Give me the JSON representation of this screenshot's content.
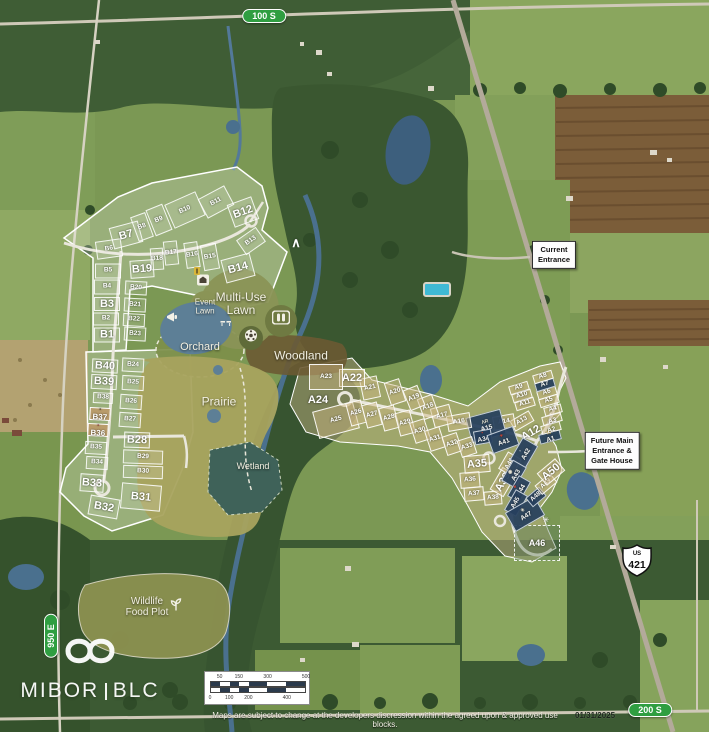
{
  "meta": {
    "width": 709,
    "height": 732
  },
  "road_labels": [
    {
      "id": "100-s",
      "text": "100 S"
    },
    {
      "id": "950-e",
      "text": "950 E"
    },
    {
      "id": "200-s",
      "text": "200 S"
    }
  ],
  "highway_shield": {
    "us": "US",
    "number": "421"
  },
  "callouts": [
    {
      "id": "current-entrance",
      "lines": [
        "Current",
        "Entrance"
      ]
    },
    {
      "id": "future-entrance",
      "lines": [
        "Future Main",
        "Entrance &",
        "Gate House"
      ]
    }
  ],
  "amenity_labels": [
    {
      "id": "event-lawn",
      "lines": [
        "Event",
        "Lawn"
      ],
      "x": 205,
      "y": 307,
      "fs": 8
    },
    {
      "id": "multi-use-lawn",
      "lines": [
        "Multi-Use",
        "Lawn"
      ],
      "x": 241,
      "y": 304,
      "fs": 12
    },
    {
      "id": "orchard",
      "lines": [
        "Orchard"
      ],
      "x": 200,
      "y": 348,
      "fs": 11
    },
    {
      "id": "woodland",
      "lines": [
        "Woodland"
      ],
      "x": 301,
      "y": 356,
      "fs": 12
    },
    {
      "id": "prairie",
      "lines": [
        "Prairie"
      ],
      "x": 219,
      "y": 402,
      "fs": 12
    },
    {
      "id": "wetland",
      "lines": [
        "Wetland"
      ],
      "x": 253,
      "y": 467,
      "fs": 9
    },
    {
      "id": "wildlife-food-plot",
      "lines": [
        "Wildlife",
        "Food Plot"
      ],
      "x": 147,
      "y": 608,
      "fs": 10
    }
  ],
  "icons": [
    {
      "name": "barn-icon"
    },
    {
      "name": "h-marker-icon"
    },
    {
      "name": "megaphone-icon"
    },
    {
      "name": "picnic-icon"
    },
    {
      "name": "soccer-ball-icon"
    },
    {
      "name": "pickleball-court-icon"
    },
    {
      "name": "mountain-icon",
      "glyph": "∧"
    },
    {
      "name": "sprout-icon"
    },
    {
      "name": "compass-icon",
      "glyph": "✳"
    }
  ],
  "mountain_glyph": "∧",
  "lots": {
    "b": [
      {
        "id": "B1",
        "x": 107,
        "y": 335,
        "w": 26,
        "h": 15,
        "r": 0,
        "t": "g",
        "e": true
      },
      {
        "id": "B2",
        "x": 106,
        "y": 319,
        "w": 26,
        "h": 13,
        "r": 0,
        "t": "g"
      },
      {
        "id": "B3",
        "x": 107,
        "y": 304,
        "w": 26,
        "h": 14,
        "r": 0,
        "t": "g",
        "e": true
      },
      {
        "id": "B4",
        "x": 107,
        "y": 287,
        "w": 26,
        "h": 15,
        "r": 0,
        "t": "g"
      },
      {
        "id": "B5",
        "x": 108,
        "y": 271,
        "w": 26,
        "h": 15,
        "r": 0,
        "t": "g"
      },
      {
        "id": "B6",
        "x": 109,
        "y": 249,
        "w": 26,
        "h": 18,
        "r": -8,
        "t": "g"
      },
      {
        "id": "B7",
        "x": 126,
        "y": 235,
        "w": 30,
        "h": 22,
        "r": -15,
        "t": "g",
        "e": true
      },
      {
        "id": "B8",
        "x": 142,
        "y": 227,
        "w": 16,
        "h": 26,
        "r": -20,
        "t": "g"
      },
      {
        "id": "B9",
        "x": 159,
        "y": 220,
        "w": 18,
        "h": 28,
        "r": -22,
        "t": "g"
      },
      {
        "id": "B10",
        "x": 185,
        "y": 210,
        "w": 34,
        "h": 26,
        "r": -24,
        "t": "g"
      },
      {
        "id": "B11",
        "x": 216,
        "y": 202,
        "w": 30,
        "h": 22,
        "r": -28,
        "t": "g"
      },
      {
        "id": "B12",
        "x": 243,
        "y": 212,
        "w": 26,
        "h": 24,
        "r": -20,
        "t": "g",
        "e": true
      },
      {
        "id": "B13",
        "x": 251,
        "y": 241,
        "w": 24,
        "h": 18,
        "r": -35,
        "t": "g"
      },
      {
        "id": "B14",
        "x": 238,
        "y": 268,
        "w": 30,
        "h": 24,
        "r": -15,
        "t": "g",
        "e": true
      },
      {
        "id": "B15",
        "x": 210,
        "y": 257,
        "w": 16,
        "h": 26,
        "r": -10,
        "t": "g"
      },
      {
        "id": "B16",
        "x": 192,
        "y": 255,
        "w": 14,
        "h": 26,
        "r": -8,
        "t": "g"
      },
      {
        "id": "B17",
        "x": 171,
        "y": 253,
        "w": 14,
        "h": 24,
        "r": -6,
        "t": "g"
      },
      {
        "id": "B18",
        "x": 157,
        "y": 259,
        "w": 13,
        "h": 22,
        "r": -4,
        "t": "g"
      },
      {
        "id": "B19",
        "x": 142,
        "y": 269,
        "w": 24,
        "h": 18,
        "r": -4,
        "t": "g",
        "e": true
      },
      {
        "id": "B20",
        "x": 136,
        "y": 288,
        "w": 22,
        "h": 14,
        "r": 3,
        "t": "g"
      },
      {
        "id": "B21",
        "x": 135,
        "y": 305,
        "w": 22,
        "h": 14,
        "r": 3,
        "t": "g"
      },
      {
        "id": "B22",
        "x": 134,
        "y": 320,
        "w": 22,
        "h": 13,
        "r": 3,
        "t": "g"
      },
      {
        "id": "B23",
        "x": 135,
        "y": 334,
        "w": 22,
        "h": 14,
        "r": 3,
        "t": "g"
      },
      {
        "id": "B24",
        "x": 133,
        "y": 365,
        "w": 22,
        "h": 14,
        "r": 3,
        "t": "g"
      },
      {
        "id": "B25",
        "x": 133,
        "y": 383,
        "w": 22,
        "h": 15,
        "r": 3,
        "t": "g"
      },
      {
        "id": "B26",
        "x": 131,
        "y": 402,
        "w": 22,
        "h": 15,
        "r": 4,
        "t": "g"
      },
      {
        "id": "B27",
        "x": 130,
        "y": 420,
        "w": 22,
        "h": 15,
        "r": 4,
        "t": "g"
      },
      {
        "id": "B28",
        "x": 137,
        "y": 440,
        "w": 26,
        "h": 16,
        "r": 2,
        "t": "g",
        "e": true
      },
      {
        "id": "B29",
        "x": 143,
        "y": 457,
        "w": 40,
        "h": 14,
        "r": 2,
        "t": "g"
      },
      {
        "id": "B30",
        "x": 143,
        "y": 472,
        "w": 40,
        "h": 13,
        "r": 2,
        "t": "g"
      },
      {
        "id": "B31",
        "x": 141,
        "y": 497,
        "w": 40,
        "h": 26,
        "r": 5,
        "t": "g",
        "e": true
      },
      {
        "id": "B32",
        "x": 104,
        "y": 507,
        "w": 30,
        "h": 20,
        "r": 10,
        "t": "g",
        "e": true
      },
      {
        "id": "B33",
        "x": 92,
        "y": 483,
        "w": 24,
        "h": 18,
        "r": 4,
        "t": "g",
        "e": true
      },
      {
        "id": "B34",
        "x": 97,
        "y": 463,
        "w": 22,
        "h": 13,
        "r": 3,
        "t": "g"
      },
      {
        "id": "B35",
        "x": 96,
        "y": 448,
        "w": 22,
        "h": 13,
        "r": 3,
        "t": "g"
      },
      {
        "id": "B36",
        "x": 98,
        "y": 430,
        "w": 21,
        "h": 13,
        "r": 3,
        "t": "p",
        "e": true,
        "fs": 8,
        "logo": "▪",
        "lc": "#8a3030"
      },
      {
        "id": "B37",
        "x": 100,
        "y": 414,
        "w": 21,
        "h": 13,
        "r": 3,
        "t": "p",
        "e": true,
        "fs": 8,
        "logo": "▪",
        "lc": "#4a3a28"
      },
      {
        "id": "B38",
        "x": 103,
        "y": 398,
        "w": 20,
        "h": 11,
        "r": 3,
        "t": "g"
      },
      {
        "id": "B39",
        "x": 104,
        "y": 382,
        "w": 26,
        "h": 15,
        "r": 3,
        "t": "g",
        "e": true
      },
      {
        "id": "B40",
        "x": 105,
        "y": 366,
        "w": 26,
        "h": 14,
        "r": 3,
        "t": "g",
        "e": true
      }
    ],
    "a": [
      {
        "id": "A1",
        "x": 550,
        "y": 437,
        "w": 22,
        "h": 10,
        "r": -15,
        "t": "n",
        "logo": "M",
        "lc": "#d8b04a"
      },
      {
        "id": "A2",
        "x": 551,
        "y": 428,
        "w": 20,
        "h": 9,
        "r": -15,
        "t": "t",
        "logo": "✳",
        "lc": "#ffffff"
      },
      {
        "id": "A3",
        "x": 552,
        "y": 419,
        "w": 20,
        "h": 9,
        "r": -15,
        "t": "t",
        "logo": "✳",
        "lc": "#ffffff"
      },
      {
        "id": "A4",
        "x": 553,
        "y": 410,
        "w": 18,
        "h": 9,
        "r": -15,
        "t": "t"
      },
      {
        "id": "A5",
        "x": 549,
        "y": 401,
        "w": 20,
        "h": 9,
        "r": -17,
        "t": "t"
      },
      {
        "id": "A6",
        "x": 547,
        "y": 393,
        "w": 20,
        "h": 9,
        "r": -17,
        "t": "t"
      },
      {
        "id": "A7",
        "x": 545,
        "y": 385,
        "w": 20,
        "h": 9,
        "r": -17,
        "t": "n"
      },
      {
        "id": "A8",
        "x": 543,
        "y": 377,
        "w": 20,
        "h": 9,
        "r": -17,
        "t": "t"
      },
      {
        "id": "A9",
        "x": 519,
        "y": 388,
        "w": 20,
        "h": 9,
        "r": -17,
        "t": "t"
      },
      {
        "id": "A10",
        "x": 522,
        "y": 396,
        "w": 20,
        "h": 9,
        "r": -17,
        "t": "t"
      },
      {
        "id": "A11",
        "x": 525,
        "y": 404,
        "w": 20,
        "h": 9,
        "r": -17,
        "t": "t"
      },
      {
        "id": "A12",
        "x": 531,
        "y": 433,
        "w": 30,
        "h": 16,
        "r": -30,
        "t": "x",
        "e": true
      },
      {
        "id": "A13",
        "x": 522,
        "y": 421,
        "w": 22,
        "h": 12,
        "r": -30,
        "t": "t"
      },
      {
        "id": "A14",
        "x": 504,
        "y": 422,
        "w": 22,
        "h": 14,
        "r": -10,
        "t": "t"
      },
      {
        "id": "A15",
        "x": 486,
        "y": 426,
        "w": 36,
        "h": 26,
        "r": -15,
        "t": "n",
        "logo": "ΛR",
        "lc": "#e8e4d8"
      },
      {
        "id": "A16",
        "x": 459,
        "y": 422,
        "w": 24,
        "h": 16,
        "r": -10,
        "t": "t"
      },
      {
        "id": "A17",
        "x": 442,
        "y": 416,
        "w": 20,
        "h": 20,
        "r": -15,
        "t": "t"
      },
      {
        "id": "A18",
        "x": 428,
        "y": 407,
        "w": 16,
        "h": 22,
        "r": -20,
        "t": "t"
      },
      {
        "id": "A19",
        "x": 414,
        "y": 398,
        "w": 16,
        "h": 22,
        "r": -22,
        "t": "t"
      },
      {
        "id": "A20",
        "x": 395,
        "y": 392,
        "w": 16,
        "h": 24,
        "r": -18,
        "t": "t"
      },
      {
        "id": "A21",
        "x": 370,
        "y": 388,
        "w": 18,
        "h": 22,
        "r": -12,
        "t": "t"
      },
      {
        "id": "A22",
        "x": 352,
        "y": 378,
        "w": 26,
        "h": 18,
        "r": 0,
        "t": "t",
        "e": true
      },
      {
        "id": "A23",
        "x": 326,
        "y": 377,
        "w": 34,
        "h": 26,
        "r": 0,
        "t": "t"
      },
      {
        "id": "A24",
        "x": 318,
        "y": 400,
        "w": 30,
        "h": 22,
        "r": 0,
        "t": "x",
        "e": true
      },
      {
        "id": "A25",
        "x": 336,
        "y": 420,
        "w": 42,
        "h": 28,
        "r": -15,
        "t": "t"
      },
      {
        "id": "A26",
        "x": 356,
        "y": 413,
        "w": 16,
        "h": 24,
        "r": -15,
        "t": "t"
      },
      {
        "id": "A27",
        "x": 372,
        "y": 415,
        "w": 16,
        "h": 24,
        "r": -15,
        "t": "t"
      },
      {
        "id": "A28",
        "x": 389,
        "y": 418,
        "w": 16,
        "h": 24,
        "r": -15,
        "t": "t"
      },
      {
        "id": "A29",
        "x": 405,
        "y": 423,
        "w": 16,
        "h": 24,
        "r": -15,
        "t": "t"
      },
      {
        "id": "A30",
        "x": 420,
        "y": 431,
        "w": 16,
        "h": 22,
        "r": -18,
        "t": "t"
      },
      {
        "id": "A31",
        "x": 435,
        "y": 439,
        "w": 16,
        "h": 22,
        "r": -18,
        "t": "t"
      },
      {
        "id": "A32",
        "x": 452,
        "y": 444,
        "w": 16,
        "h": 20,
        "r": -18,
        "t": "t"
      },
      {
        "id": "A33",
        "x": 467,
        "y": 447,
        "w": 16,
        "h": 18,
        "r": -18,
        "t": "t"
      },
      {
        "id": "A34",
        "x": 483,
        "y": 437,
        "w": 18,
        "h": 14,
        "r": -10,
        "t": "n",
        "logo": "▪",
        "lc": "#c43b2e"
      },
      {
        "id": "A35",
        "x": 477,
        "y": 464,
        "w": 26,
        "h": 18,
        "r": -5,
        "t": "t",
        "e": true
      },
      {
        "id": "A36",
        "x": 470,
        "y": 480,
        "w": 20,
        "h": 16,
        "r": -5,
        "t": "t"
      },
      {
        "id": "A37",
        "x": 474,
        "y": 494,
        "w": 20,
        "h": 14,
        "r": -5,
        "t": "t"
      },
      {
        "id": "A38",
        "x": 493,
        "y": 498,
        "w": 18,
        "h": 14,
        "r": -5,
        "t": "t"
      },
      {
        "id": "A39",
        "x": 503,
        "y": 482,
        "w": 26,
        "h": 16,
        "r": -60,
        "t": "t",
        "e": true
      },
      {
        "id": "A40",
        "x": 510,
        "y": 464,
        "w": 20,
        "h": 16,
        "r": -60,
        "t": "t"
      },
      {
        "id": "A41",
        "x": 503,
        "y": 440,
        "w": 28,
        "h": 20,
        "r": -20,
        "t": "n",
        "logo": "✦",
        "lc": "#c43b2e"
      },
      {
        "id": "A42",
        "x": 524,
        "y": 453,
        "w": 26,
        "h": 18,
        "r": -60,
        "t": "n",
        "logo": "▫",
        "lc": "#ffffff"
      },
      {
        "id": "A43",
        "x": 514,
        "y": 474,
        "w": 24,
        "h": 16,
        "r": -60,
        "t": "n",
        "logo": "◉",
        "lc": "#e8e4d8"
      },
      {
        "id": "A44",
        "x": 519,
        "y": 489,
        "w": 24,
        "h": 14,
        "r": -60,
        "t": "n",
        "logo": "✦",
        "lc": "#c43b2e"
      },
      {
        "id": "A45",
        "x": 516,
        "y": 503,
        "w": 24,
        "h": 14,
        "r": -60,
        "t": "n"
      },
      {
        "id": "A46",
        "x": 537,
        "y": 543,
        "w": 46,
        "h": 36,
        "r": 0,
        "t": "d",
        "fs": 9
      },
      {
        "id": "A47",
        "x": 525,
        "y": 514,
        "w": 34,
        "h": 22,
        "r": -30,
        "t": "n",
        "logo": "✳",
        "lc": "#e8e4d8"
      },
      {
        "id": "A48",
        "x": 536,
        "y": 497,
        "w": 18,
        "h": 12,
        "r": -40,
        "t": "n"
      },
      {
        "id": "A49",
        "x": 546,
        "y": 484,
        "w": 20,
        "h": 12,
        "r": -40,
        "t": "t"
      },
      {
        "id": "A50",
        "x": 551,
        "y": 472,
        "w": 24,
        "h": 16,
        "r": -40,
        "t": "t",
        "e": true
      }
    ]
  },
  "scale_bar": {
    "top": [
      {
        "t": "50",
        "p": 10
      },
      {
        "t": "150",
        "p": 30
      },
      {
        "t": "300",
        "p": 60
      },
      {
        "t": "500",
        "p": 100
      }
    ],
    "bottom": [
      {
        "t": "0",
        "p": 0
      },
      {
        "t": "100",
        "p": 20
      },
      {
        "t": "200",
        "p": 40
      },
      {
        "t": "400",
        "p": 80
      }
    ]
  },
  "footer": {
    "disclaimer": "Maps are subject to change at the developers discression within the agreed upon & approved use blocks.",
    "date": "01/31/2025"
  },
  "logo": {
    "left": "MIBOR",
    "right": "BLC"
  },
  "colors": {
    "navy_lot": "#27405e",
    "road_pill_green": "#2f9e41",
    "water": "#4a708e",
    "accent_red": "#c43b2e"
  }
}
